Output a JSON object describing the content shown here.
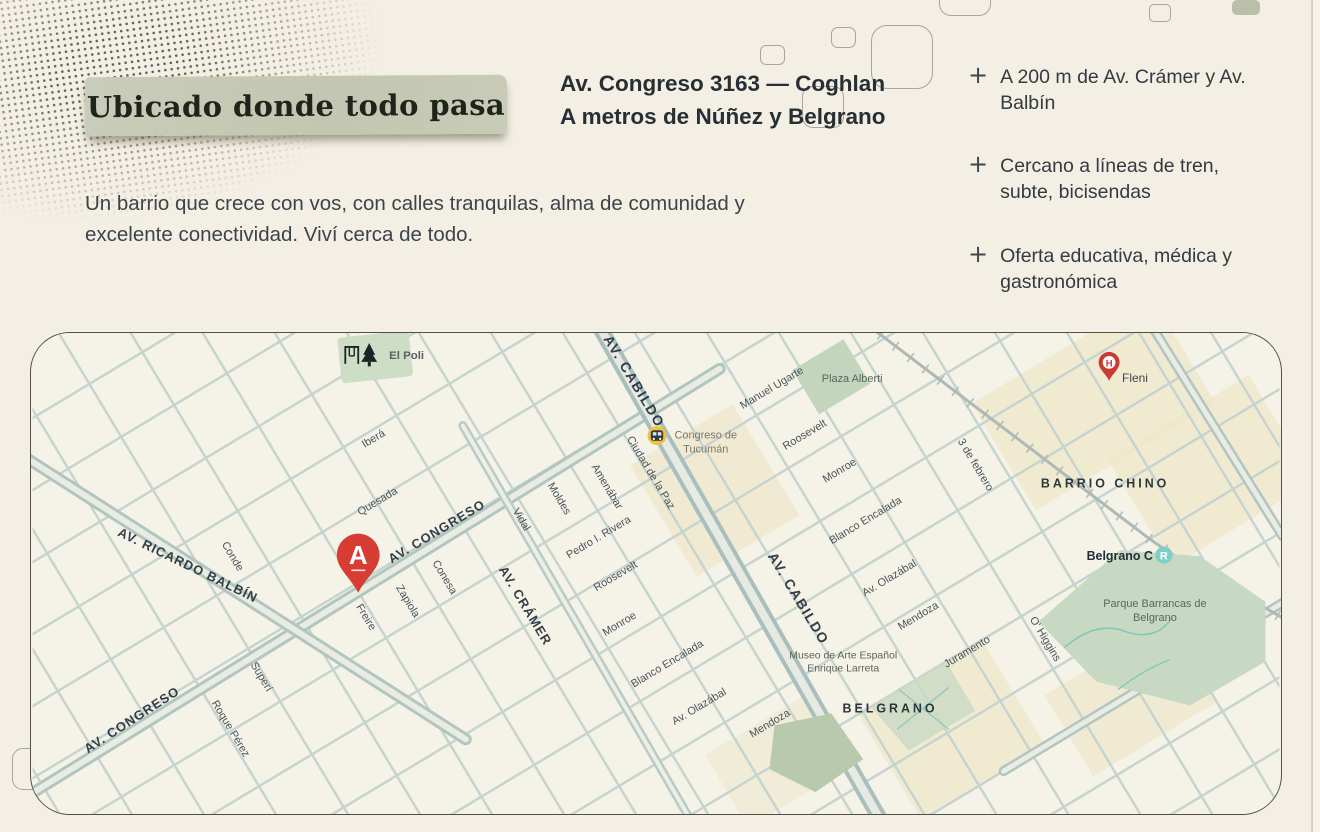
{
  "header": {
    "badge": "Ubicado donde todo pasa",
    "title_line1": "Av. Congreso 3163 — Coghlan",
    "title_line2": "A metros de Núñez y Belgrano",
    "paragraph": "Un barrio que crece con vos, con calles tranquilas, alma de comunidad y excelente conectividad. Viví cerca de todo."
  },
  "highlights": {
    "plus": "+",
    "items": [
      {
        "text": "A 200 m de Av. Crámer y Av. Balbín"
      },
      {
        "text": "Cercano a líneas de tren, subte, bicisendas"
      },
      {
        "text": "Oferta educativa, médica y gastronómica"
      }
    ]
  },
  "map": {
    "marker": {
      "letter": "A"
    },
    "street_labels": {
      "ibera": "Iberá",
      "quesada": "Quesada",
      "conde": "Conde",
      "superi": "Superí",
      "roque_perez": "Roque Pérez",
      "freire": "Freire",
      "zapiola": "Zapiola",
      "conesa": "Conesa",
      "vidal": "Vidal",
      "moldes": "Moldes",
      "amenabar": "Amenábar",
      "ciudad_de_la_paz": "Ciudad de la Paz",
      "pedro_rivera": "Pedro I. Rivera",
      "roosevelt": "Roosevelt",
      "monroe": "Monroe",
      "blanco_encalada": "Blanco Encalada",
      "olazabal": "Av. Olazábal",
      "mendoza": "Mendoza",
      "juramento": "Juramento",
      "ohiggins": "O' Higgins",
      "tres_de_febrero": "3 de febrero",
      "manuel_ugarte": "Manuel Ugarte",
      "balbin": "AV. RICARDO BALBÍN",
      "congreso": "AV. CONGRESO",
      "cramer": "AV. CRÁMER",
      "cabildo": "AV. CABILDO"
    },
    "areas": {
      "barrio_chino": "BARRIO CHINO",
      "belgrano": "BELGRANO"
    },
    "pois": {
      "el_poli": "El Poli",
      "congreso_tucuman_l1": "Congreso de",
      "congreso_tucuman_l2": "Tucumán",
      "plaza_alberti": "Plaza Alberti",
      "fleni": "Fleni",
      "fleni_icon_letter": "H",
      "belgrano_c": "Belgrano C",
      "belgrano_c_icon_letter": "R",
      "museo_l1": "Museo de Arte Español",
      "museo_l2": "Enrique Larreta",
      "parque_l1": "Parque Barrancas de",
      "parque_l2": "Belgrano"
    },
    "colors": {
      "marker_red": "#d63d33",
      "station_yellow": "#f1c337",
      "rail_station_teal": "#7ed0c6",
      "park_green": "#c7d9c2",
      "street": "#c6d4d0",
      "avenue": "#b2c5c1",
      "commercial": "#efe7cb",
      "map_bg": "#f5f2e8"
    }
  }
}
